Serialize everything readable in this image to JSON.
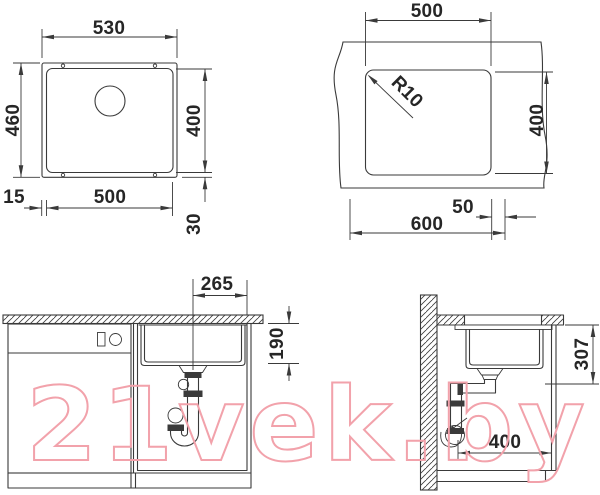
{
  "colors": {
    "line": "#3a3a3a",
    "watermark": "#f2a2ab",
    "background": "#ffffff"
  },
  "watermark": {
    "text": "21vek.by"
  },
  "diagrams": {
    "sink_top_view": {
      "dims": {
        "outer_width": "530",
        "outer_depth": "460",
        "bowl_width": "500",
        "bowl_depth": "400",
        "rim_left": "15",
        "rim_bottom": "30"
      }
    },
    "worktop_cutout": {
      "dims": {
        "cutout_width": "500",
        "cutout_depth": "400",
        "corner_radius": "R10",
        "cabinet_width": "600",
        "edge_distance": "50"
      }
    },
    "front_section": {
      "dims": {
        "drain_offset": "265",
        "bowl_height": "190"
      }
    },
    "side_section": {
      "dims": {
        "drain_depth": "307",
        "clearance_width": "400"
      }
    }
  }
}
